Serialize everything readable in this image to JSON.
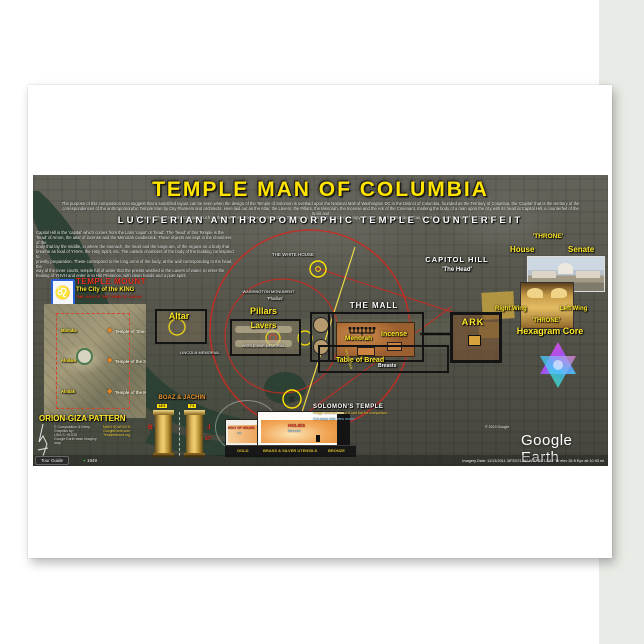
{
  "title_block": {
    "title": "TEMPLE MAN OF COLUMBIA",
    "intro1": "The purpose of this composition is to suggest that a sanctified layout can be seen when the design of the Temple of Solomon is overlaid upon the National Mall of Washington DC in the District of Columbia, founded as the Territory of Columbia, the 'Capital' that is the territory of the",
    "intro2": "correspondences of the anthropomorphic Temple Man by City Planners and architects. Here laid out as the Altar, the Lavers, the Pillars, the Menorah, the Incense and the Ark of the Covenant, marking the body of a man upon the city with its head at Capitol Hill, a counterfeit of the Spirit and",
    "intro3": "holiness of the Menorah. Compare such as the true Spirit God given perspective. The graphic illustrates a Luciferian copy of 'man' as in the Temple below, priest-like, even the Ark of the Covenant, etc.",
    "subtitle": "LUCIFERIAN  ANTHROPOMORPHIC  TEMPLE  COUNTERFEIT"
  },
  "left_text": {
    "l1": "Capitol Hill is the 'capital' which comes from the Latin 'caput' or 'head'. The 'head' of this Temple is the",
    "l2": "'head' of Amon, the altar of incense and the Menorah candlestick. These objects are kept in the chambers of the",
    "l3": "body that lay the middle, in where the stomach, the heart and the lungs are, of the organs on a body that",
    "l4": "breathe as food of YHVH, the Holy Spirit, etc. The outside chambers of the body of the building correspond to",
    "l5": "priestly preparation. These correspond to the long arms of the body, at the wall corresponding to the head, the",
    "l6": "way of the inner courts, temple full of water that the priests washed in the Lavers of water, to enter the",
    "l7": "healing of YHVH and enter in to His Presence, with clean hands and a pure spirit."
  },
  "map_labels": {
    "white_house": "THE WHITE HOUSE",
    "monument": "WASHINGTON MONUMENT",
    "phallus": "'Phallus'",
    "altar": "Altar",
    "pillars": "Pillars",
    "lavers": "Lavers",
    "lincoln": "LINCOLN MEMORIAL",
    "wwm": "WORLD WAR MEMORIAL",
    "mall": "THE MALL",
    "menorah": "Menorah",
    "incense": "Incense",
    "table": "Table of Bread",
    "breasts": "Breasts",
    "ark": "ARK",
    "orion": "Orion's Belt",
    "capitol": "CAPITOL HILL",
    "head": "'The Head'"
  },
  "right_col": {
    "throne1": "'THRONE'",
    "house": "House",
    "senate": "Senate",
    "right_wing": "Right Wing",
    "left_wing": "Left Wing",
    "throne2": "'THRONE'",
    "hexagram": "Hexagram Core"
  },
  "temple_mount": {
    "title": "TEMPLE MOUNT",
    "subtitle": "The City of the KING",
    "tagline": "THE LION OF THE TRIBE OF JUDAH",
    "star1": "Mintaka",
    "star2": "Alnilam",
    "star3": "Alnitak",
    "t1": "Temple of 'Shining One'",
    "t2": "Temple of the Sun",
    "t3": "Temple of the Moon",
    "pattern": "ORION-GIZA PATTERN"
  },
  "credits": {
    "c1": "© Composition & Interp Graphics by:",
    "c2": "LISA S. HOOD",
    "c3": "Google Earth base imagery map",
    "s1": "MAIN SOURCES:",
    "s2": "GoogleEarth.com",
    "s3": "TempleMount.org"
  },
  "boaz": {
    "title": "BOAZ & JACHIN",
    "tag1": "18'3",
    "tag2": "7'3",
    "b": "B",
    "j": "J",
    "h": "27'"
  },
  "solomon": {
    "title": "SOLOMON'S TEMPLE",
    "sub1": "Image knocked down & laid flat for comparison",
    "sub2": "Cut-away side view model",
    "hoh": "HOLY OF HOLIES",
    "hoh_sub": "Ark",
    "holies": "HOLIES",
    "holies_sub": "Menorah",
    "gold": "GOLD",
    "utensils": "BRASS & SILVER UTENSILS",
    "bronze": "BRONZE"
  },
  "ge": {
    "tour_guide": "Tour Guide",
    "year": "1949",
    "status": "Imagery Date: 11/13/2011      38°53'21.91\" N   77°01'13.34\" W   elev 26 ft      Eye alt 10.93 mi",
    "copyright": "© 2013 Google",
    "logo": "Google Earth"
  },
  "colors": {
    "title_yellow": "#ffe400",
    "label_yellow": "#ffe92a",
    "annotation_red": "#cc2a22",
    "map_base": "#56564c"
  }
}
